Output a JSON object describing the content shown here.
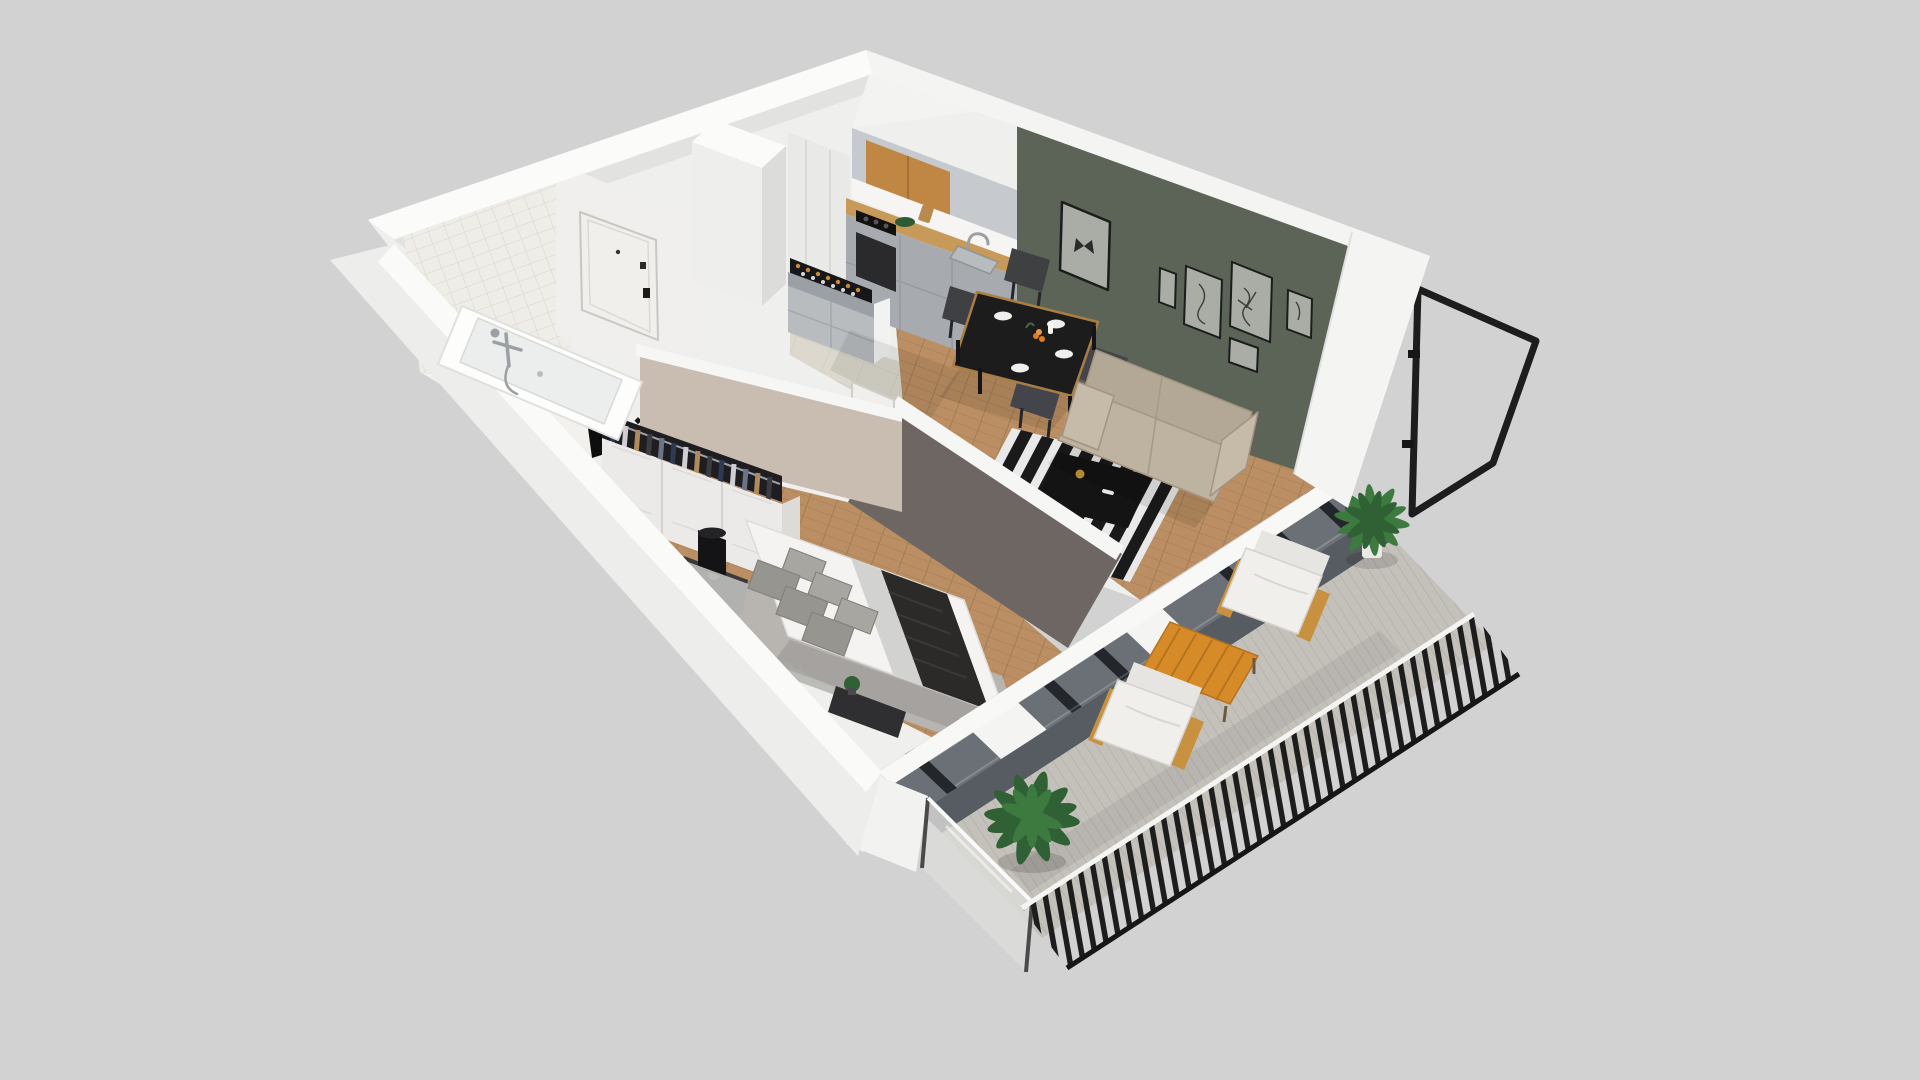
{
  "scene": {
    "kind": "3d-apartment-cutaway-floorplan-render",
    "background": "#d2d2d2",
    "view": "high-angle isometric cutaway, no visible text or UI controls"
  },
  "palette": {
    "background": "#d2d2d2",
    "underlay": "#efefed",
    "wall_cut_white": "#fbfbfa",
    "wall_cut_shaded": "#f4f4f2",
    "facade_white": "#ededeb",
    "interior_white": "#f0efed",
    "tile_wall": "#efede7",
    "green_wall": "#5c6457",
    "taupe_wall": "#6e6662",
    "greige_wall": "#c9bcb1",
    "wood_floor": "#bb8f63",
    "hall_tile": "#dcd8cd",
    "kitchen_gray": "#a7abb0",
    "kitchen_gray_light": "#c6c9cd",
    "kitchen_wood": "#c08744",
    "counter_wood": "#c89a5a",
    "sofa_beige": "#beb2a0",
    "sofa_beige_dark": "#b3a795",
    "chair_dark": "#3f4042",
    "table_black": "#1c1c1d",
    "table_wood_edge": "#a97e42",
    "rug_white": "#e9e9e9",
    "rug_black": "#1a1a1a",
    "coffee_table_black": "#141414",
    "bed_white": "#f4f3f1",
    "throw_dark": "#2b2a29",
    "pillow_gray": "#97958f",
    "bed_rug_gray": "#b7b7b5",
    "wardrobe_white": "#eceae8",
    "clothes_dark": "#1d1d22",
    "door_white": "#f1efec",
    "window_band": "#6a7076",
    "window_frame_dark": "#23272b",
    "sill_gray": "#565c61",
    "balcony_floor": "#c4c0ba",
    "railing_black": "#1d1d1d",
    "orange_table": "#d78b28",
    "wood_arm": "#c8913f",
    "cushion_white": "#f0efec",
    "plant_green": "#2f6134",
    "plant_green_light": "#3c7a40",
    "lamp_black": "#141416",
    "art_canvas": "#a9ada6",
    "art_frame": "#1c1c1c"
  },
  "rooms": {
    "bathroom": {
      "items": [
        "tile-wall",
        "bathtub",
        "shower-mixer",
        "towel",
        "checker-floor-dots"
      ]
    },
    "hallway": {
      "items": [
        "entrance-door",
        "door-handle",
        "ventilation-column",
        "tile-floor"
      ]
    },
    "kitchen": {
      "items": [
        "upper-cabinets",
        "oak-cabinet-doors",
        "splashback",
        "wood-countertop",
        "cooktop",
        "oven",
        "sink",
        "faucet",
        "fruit-bowl",
        "wine-rack-with-bottles"
      ]
    },
    "living_room": {
      "items": [
        "green-accent-wall",
        "butterfly-artwork",
        "gallery-frames",
        "dining-table",
        "dining-chairs",
        "table-setting",
        "sofa",
        "striped-rug",
        "coffee-table",
        "window-bench"
      ],
      "gallery_frame_count": 5,
      "dining_chair_count": 4
    },
    "bedroom": {
      "items": [
        "greige-wall",
        "wardrobe",
        "hanging-clothes",
        "table-lamp",
        "nightstand",
        "bed",
        "pillows",
        "gray-fold",
        "dark-throw",
        "foot-bench",
        "potted-plant",
        "area-rug",
        "open-door"
      ],
      "pillow_count": 6
    },
    "balcony": {
      "items": [
        "plank-floor",
        "palm-plant",
        "large-green-plant",
        "lounge-chairs",
        "orange-slat-table",
        "frosted-glass-partition",
        "black-slat-railing",
        "open-railing-frame"
      ],
      "lounge_chair_count": 2
    }
  }
}
